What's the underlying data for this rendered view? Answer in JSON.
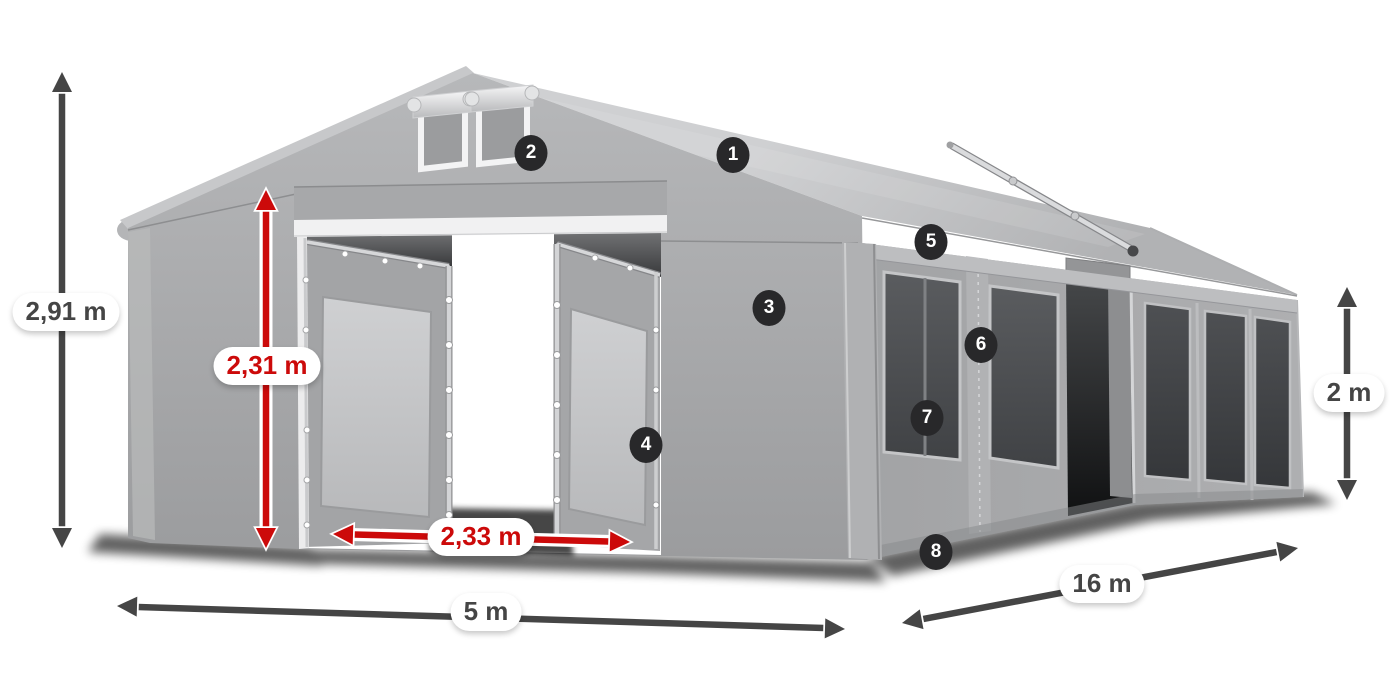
{
  "page": {
    "title": "Tent dimensions diagram",
    "background": "#ffffff"
  },
  "colors": {
    "dimension_dark": "#454545",
    "dimension_red": "#cc0a0a",
    "badge_bg": "#28282a",
    "badge_text": "#ffffff",
    "pill_bg": "#ffffff",
    "tent_roof": "#c6c7c9",
    "tent_wall": "#a6a7a9",
    "tent_frame": "#d8d9db",
    "tent_mesh": "#4a4c4e"
  },
  "badges": [
    {
      "number": "1"
    },
    {
      "number": "2"
    },
    {
      "number": "3"
    },
    {
      "number": "4"
    },
    {
      "number": "5"
    },
    {
      "number": "6"
    },
    {
      "number": "7"
    },
    {
      "number": "8"
    }
  ],
  "dimensions": [
    {
      "id": "total-height",
      "label": "2,91 m",
      "style": "dark"
    },
    {
      "id": "entrance-height",
      "label": "2,31 m",
      "style": "red"
    },
    {
      "id": "entrance-width",
      "label": "2,33 m",
      "style": "red"
    },
    {
      "id": "front-width",
      "label": "5 m",
      "style": "dark"
    },
    {
      "id": "side-length",
      "label": "16 m",
      "style": "dark"
    },
    {
      "id": "side-height",
      "label": "2 m",
      "style": "dark"
    }
  ]
}
